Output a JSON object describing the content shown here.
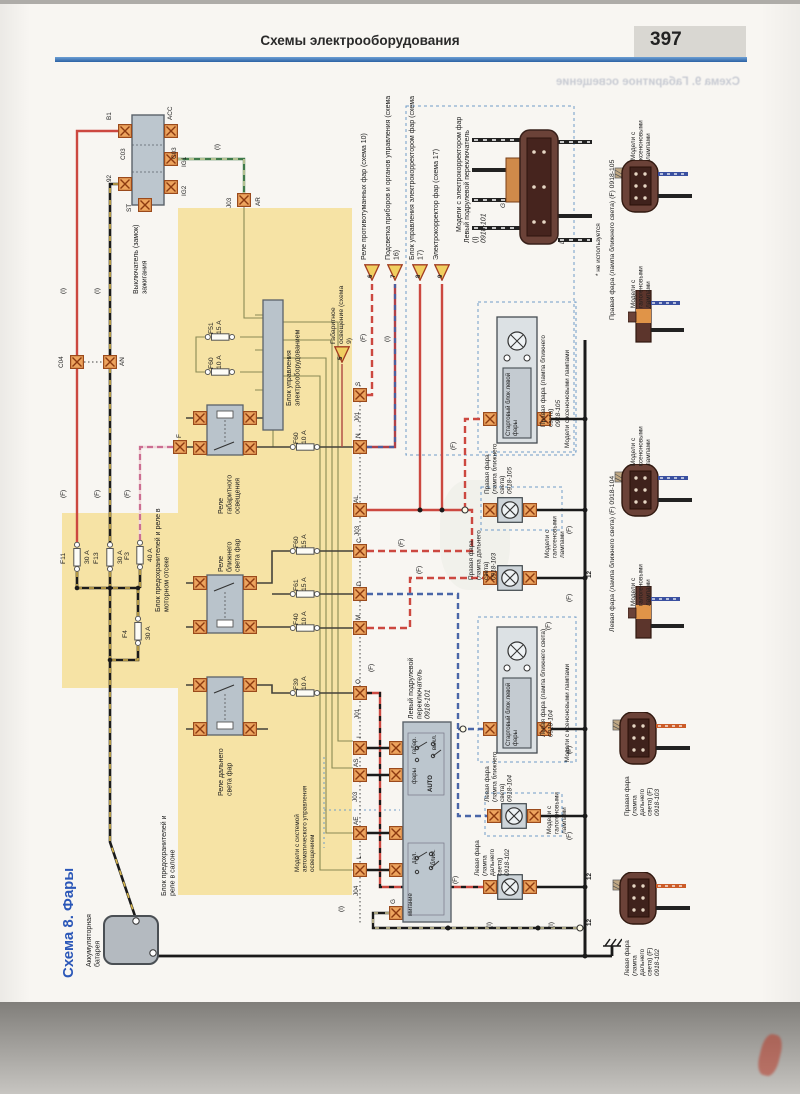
{
  "header": {
    "title": "Схемы электрооборудования",
    "page": "397",
    "ghost_title": "Схема 9. Габаритное освещение"
  },
  "diagram": {
    "title": "Схема 8. Фары"
  },
  "labels": {
    "battery": "Аккумуляторная батарея",
    "ignition": "Выключатель (замок) зажигания",
    "engine_box": "Блок предохранителей и реле в моторном отсеке",
    "cabin_box": "Блок предохранителей и реле в салоне",
    "control_unit": "Блок управления электрооборудованием",
    "relay_parking": "Реле габаритного освещения",
    "relay_low": "Реле ближнего света фар",
    "relay_high": "Реле дальнего света фар",
    "column_switch": "Левый подрулевой переключатель",
    "column_switch_num": "0918-101",
    "column_switch_top": "Левый подрулевой переключатель (I)",
    "xenon_starter": "Стартовый блок левой фары",
    "auto_models": "Модели с системой автоматического управления освещением",
    "corrector_models": "Модели с электрокорректором фар",
    "xenon_models": "Модели с ксеноновыми лампами",
    "halogen_models": "Модели с галогеновыми лампами",
    "unused": "* не используется"
  },
  "refs": {
    "r5": "Габаритное освещение (схема 9)",
    "r6": "Реле противотуманных фар (схема 10)",
    "r7": "Подсветка приборов и органов управления (схема 16)",
    "r8": "Блок управления электрокорректором фар (схема 17)",
    "r9": "Электрокорректор фар (схема 17)",
    "n5": "5",
    "n6": "6",
    "n7": "7",
    "n8": "8",
    "n9": "9"
  },
  "lamps": {
    "right_low": "Правая фара (лампа ближнего света)",
    "right_low_num": "0918-105",
    "right_high": "Правая фара (лампа дальнего света)",
    "right_high_num": "0918-103",
    "left_low": "Левая фара (лампа ближнего света)",
    "left_low_num": "0918-104",
    "left_high": "Левая фара (лампа дальнего света)",
    "left_high_num": "0918-102",
    "right_low_code": "Правая фара (лампа ближнего света) (F) 0918-105",
    "left_low_code": "Левая фара (лампа ближнего света) (F) 0918-104",
    "right_high_code": "Правая фара (лампа дальнего света) (F)",
    "left_high_code": "Левая фара (лампа дальнего света) (F)"
  },
  "switch": {
    "off": "выкл.",
    "park": "габар.",
    "head": "фары",
    "auto": "AUTO",
    "high": "дал.",
    "low": "ближ.",
    "flash": "мигание",
    "g": "G",
    "l": "L"
  },
  "fuses": {
    "f51": "F51",
    "f51_a": "15 A",
    "f60_1": "F60",
    "f60_1_a": "10 A",
    "f60_2": "F60",
    "f60_2_a": "10 A",
    "f60_3": "F60",
    "f60_3_a": "15 A",
    "f61": "F61",
    "f61_a": "15 A",
    "f40": "F40",
    "f40_a": "10 A",
    "f39": "F39",
    "f39_a": "10 A",
    "f11": "F11",
    "f11_a": "30 A",
    "f13": "F13",
    "f13_a": "30 A",
    "f3": "F3",
    "f3_a": "40 A",
    "f4": "F4",
    "f4_a": "30 A"
  },
  "pins": {
    "b1": "B1",
    "acc": "ACC",
    "ig1": "IG1",
    "ig2": "IG2",
    "st": "ST",
    "p92": "92",
    "c03": "C03",
    "c04": "C04",
    "an": "AN",
    "ar": "AR",
    "j01": "J01",
    "j03": "J03",
    "j04": "J04",
    "s": "S",
    "n": "N",
    "al": "AL",
    "c": "C",
    "d": "D",
    "m": "M",
    "o": "O",
    "i": "I",
    "as": "AS",
    "ae": "AE",
    "l": "L",
    "g": "G",
    "f": "F"
  },
  "wire": {
    "f": "(F)",
    "i": "(I)",
    "gnd": "12"
  }
}
